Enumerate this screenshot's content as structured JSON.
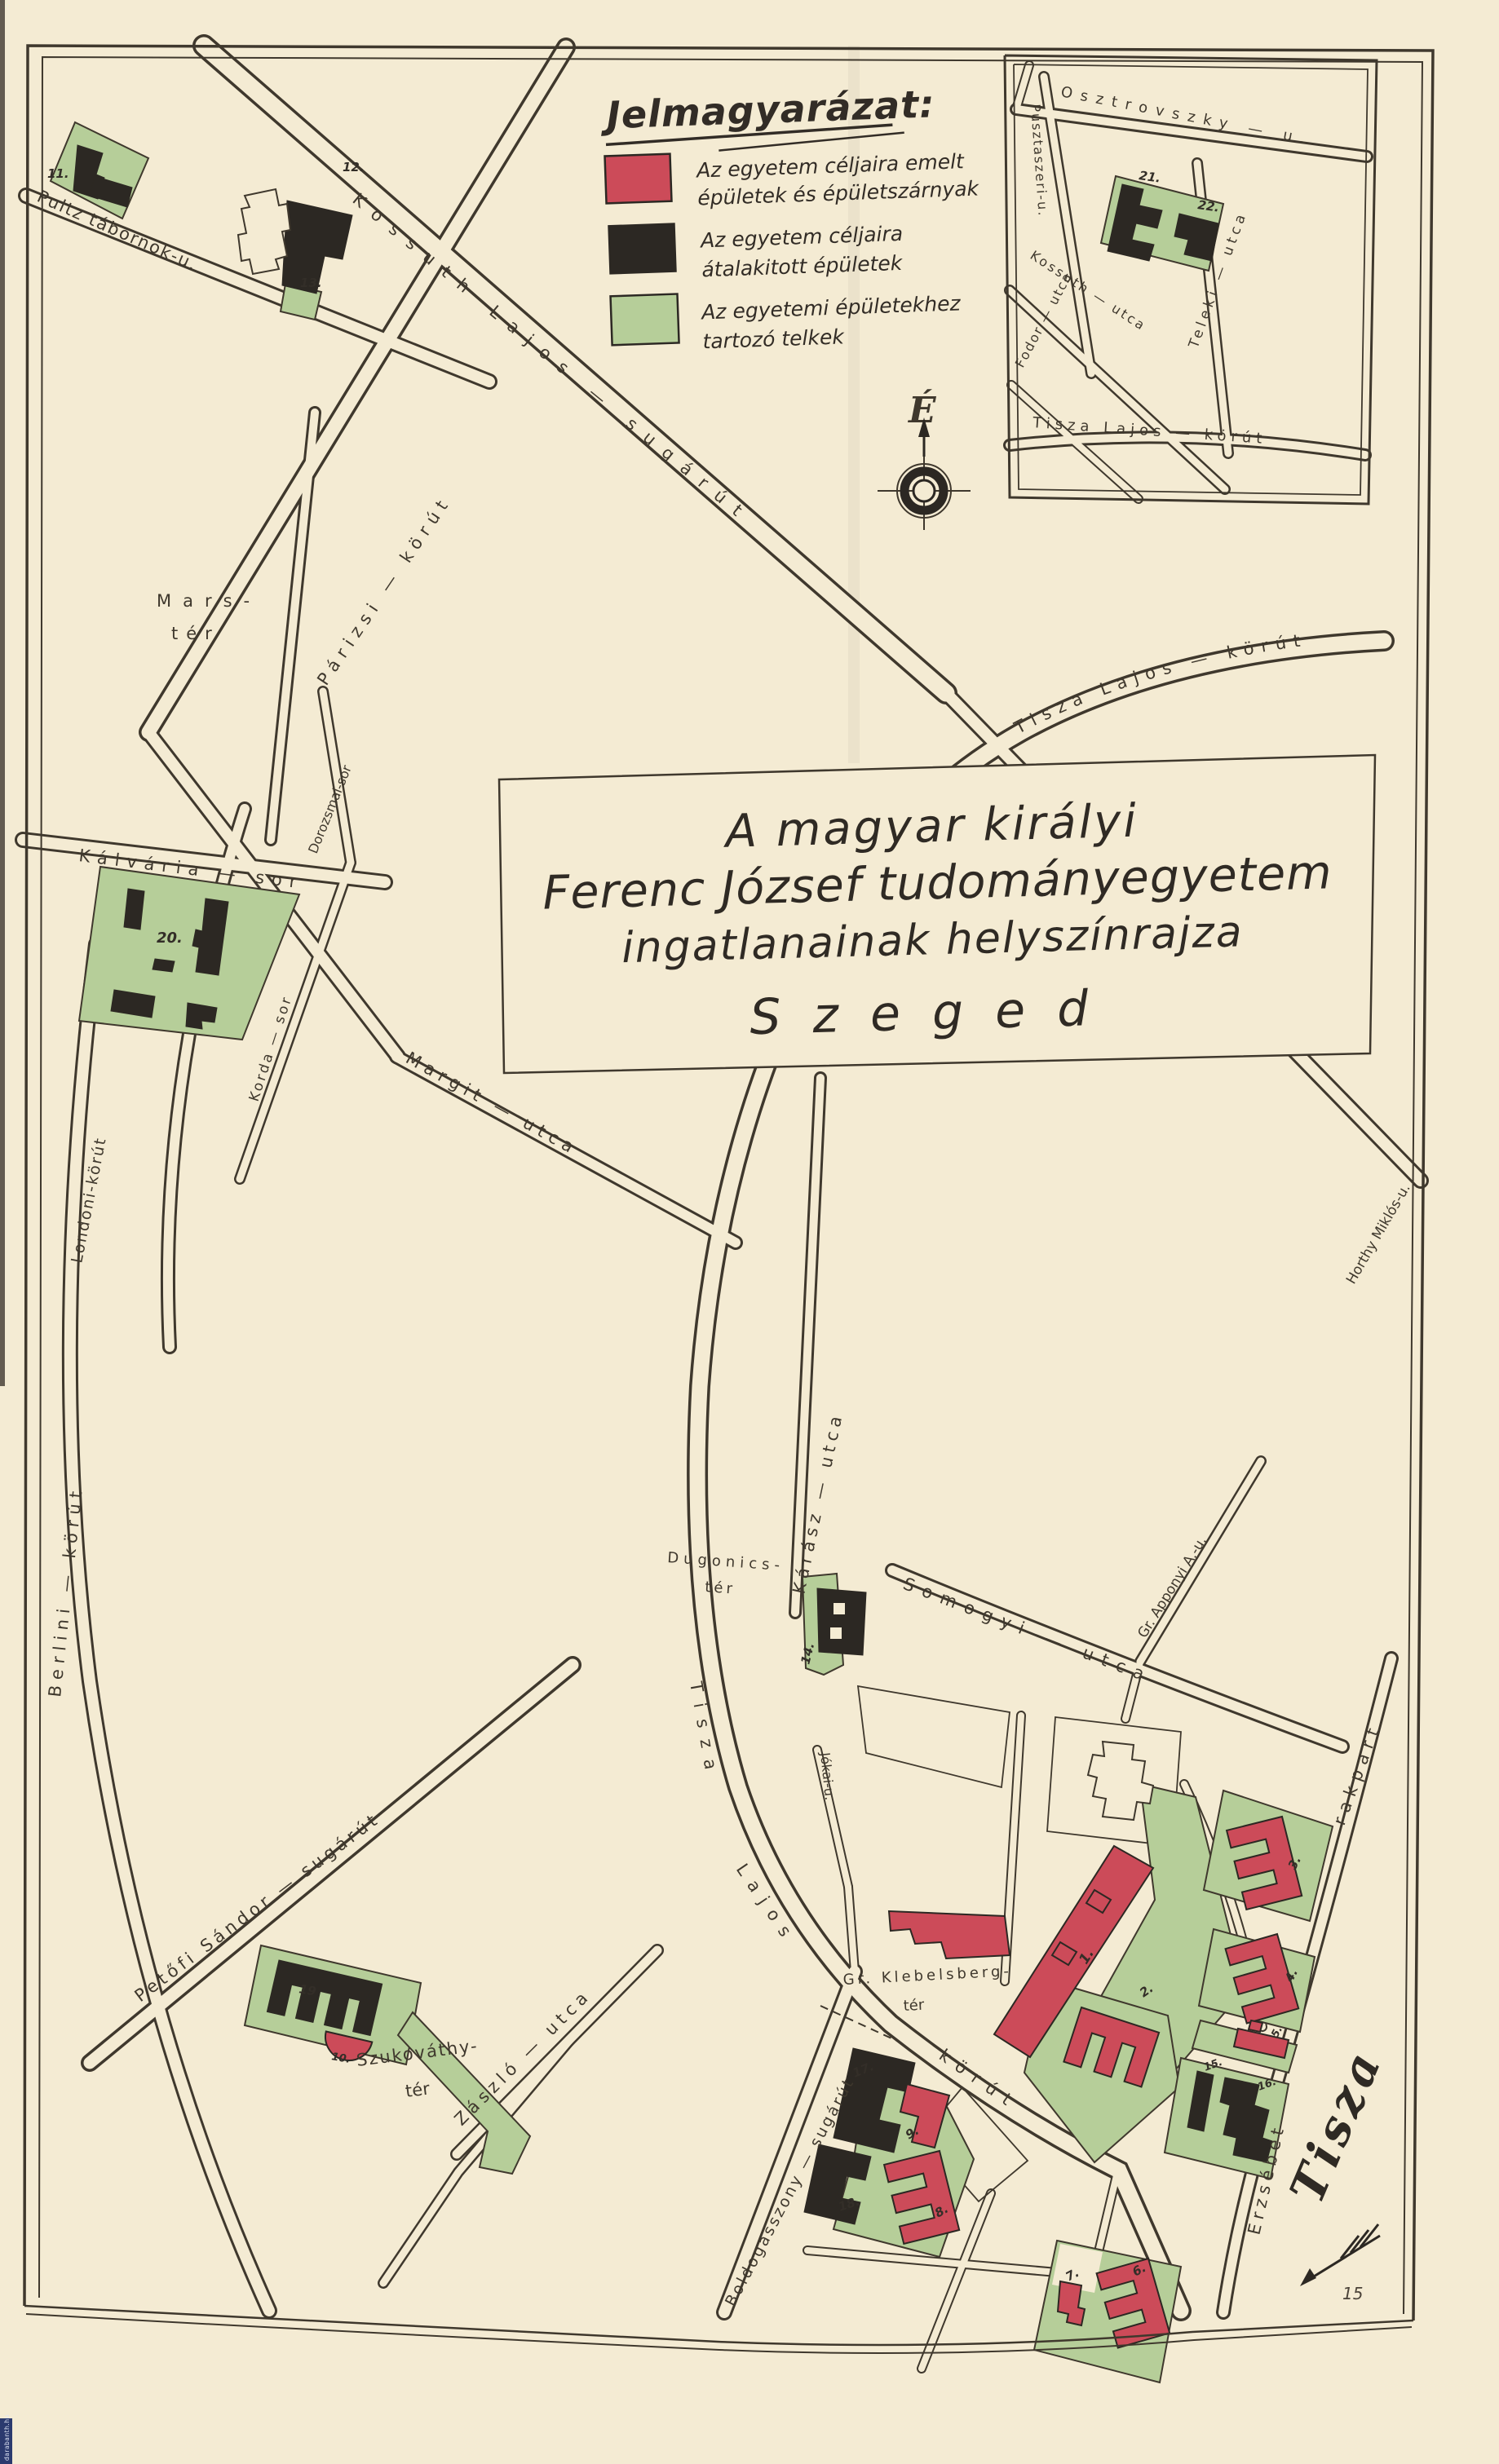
{
  "colors": {
    "paper": "#f4ebd3",
    "ink": "#3f382d",
    "red": "#cc4b59",
    "black": "#2c2823",
    "green": "#b6ce99"
  },
  "legend": {
    "title": "Jelmagyarázat:",
    "items": [
      {
        "swatch": "red",
        "line1": "Az egyetem céljaira emelt",
        "line2": "épületek és épületszárnyak"
      },
      {
        "swatch": "black",
        "line1": "Az egyetem céljaira",
        "line2": "átalakitott épületek"
      },
      {
        "swatch": "green",
        "line1": "Az egyetemi épületekhez",
        "line2": "tartozó telkek"
      }
    ]
  },
  "compass": {
    "north": "É"
  },
  "title_block": {
    "line1": "A magyar királyi",
    "line2": "Ferenc József tudományegyetem",
    "line3": "ingatlanainak helyszínrajza",
    "line4": "S z e g e d"
  },
  "streets": {
    "kossuth_lajos_sugarut": "Kossuth Lajos — sugárút",
    "pultz": "Pultz tábornok-u.",
    "parizsi": "Párizsi — körút",
    "tisza_lajos_korut": "Tisza Lajos — körút",
    "tisza_w": "Tisza",
    "lajos_w": "Lajos",
    "korut_w": "körút",
    "margit": "Margit — utca",
    "londoni": "Londoni-körút",
    "berlini": "Berlini — körút",
    "horthy": "Horthy Miklós-u.",
    "karasz": "Kárász — utca",
    "somogyi": "Somogyi — utca",
    "jokai": "Jókai-u.",
    "apponyi": "Gr. Apponyi A.-u.",
    "erzsebet": "Erzsébet",
    "rakpart": "rakpart",
    "petofi": "Petőfi Sándor — sugárút",
    "zaszlo": "Zászló — utca",
    "boldogasszony": "Boldogasszony — sugárút",
    "kalvaria": "Kálvária — sor",
    "dorozsmai": "Dorozsmai-sor",
    "korda": "Korda — sor",
    "osztrovszky": "Osztrovszky — u.",
    "pusztaszeri": "Pusztaszeri-u.",
    "kossuth_utca": "Kossuth — utca",
    "fodor": "Fodor — utca",
    "teleki": "Teleki — utca",
    "tisza_lajos_korut_inset": "Tisza Lajos — körút"
  },
  "places": {
    "mars_line1": "Mars-",
    "mars_line2": "tér",
    "dugonics_line1": "Dugonics-",
    "dugonics_line2": "tér",
    "szukovathy_line1": "Szukováthy-",
    "szukovathy_line2": "tér",
    "klebelsberg_line1": "Gr. Klebelsberg-",
    "klebelsberg_line2": "tér",
    "tisza_river": "Tisza"
  },
  "buildings": {
    "b1": "1.",
    "b2": "2.",
    "b3": "3.",
    "b4": "4.",
    "b5": "5.",
    "b6": "6.",
    "b7": "7.",
    "b8": "8.",
    "b9": "9.",
    "b10": "10.",
    "b11": "11.",
    "b12": "12.",
    "b13": "13.",
    "b14": "14.",
    "b15": "15.",
    "b16": "16.",
    "b17": "17.",
    "b18": "18.",
    "b19": "19",
    "b20": "20.",
    "b21": "21.",
    "b22": "22."
  },
  "page_number": "15",
  "watermark": "darabanth.hu"
}
